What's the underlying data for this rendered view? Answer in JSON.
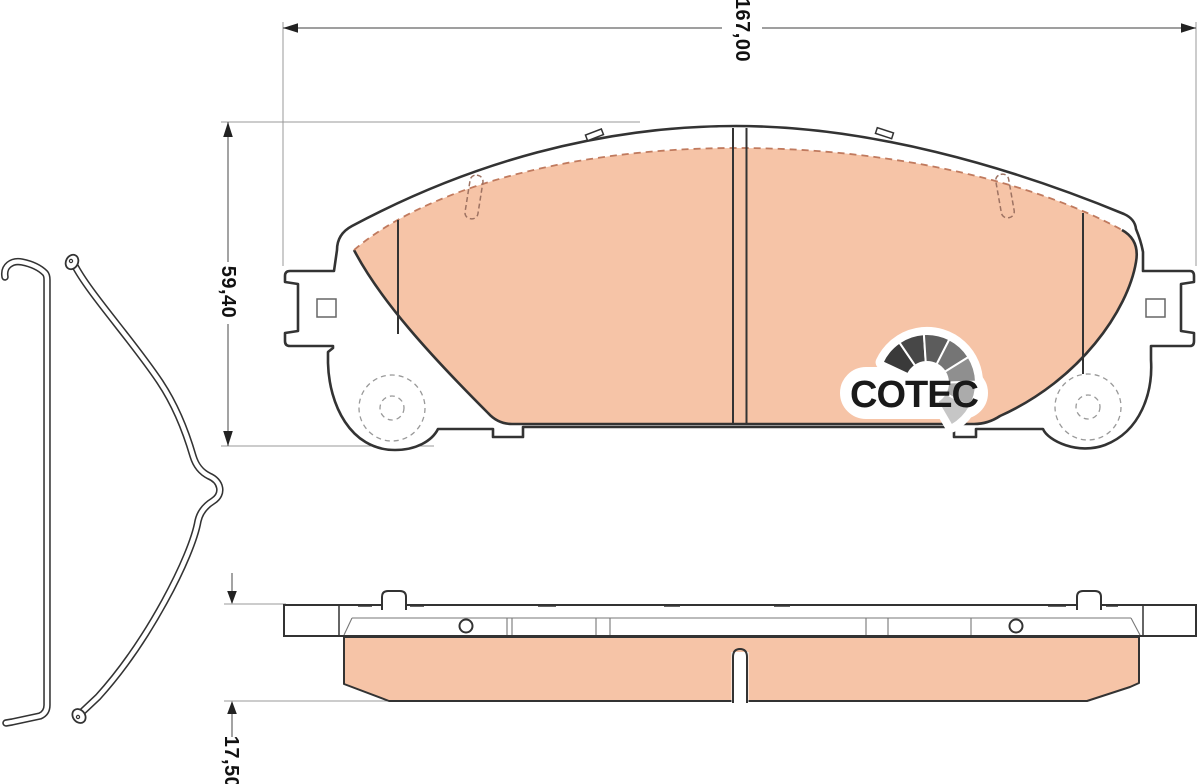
{
  "drawing": {
    "dimensions": {
      "width_mm": "167,00",
      "height_mm": "59,40",
      "thickness_mm": "17,50"
    },
    "logo": {
      "text": "COTEC",
      "icon": "gauge-fan-icon"
    },
    "colors": {
      "friction_material": "#f6c4a7",
      "friction_edge_dashed": "#c07a5e",
      "outline": "#333333",
      "dimension_line": "#777777",
      "extension_line": "#999999",
      "logo_text": "#1a1a1a",
      "logo_gauge_grays": [
        "#3a3a3a",
        "#474747",
        "#5c5c5c",
        "#757575",
        "#8f8f8f",
        "#ababab",
        "#c6c6c6"
      ]
    }
  }
}
